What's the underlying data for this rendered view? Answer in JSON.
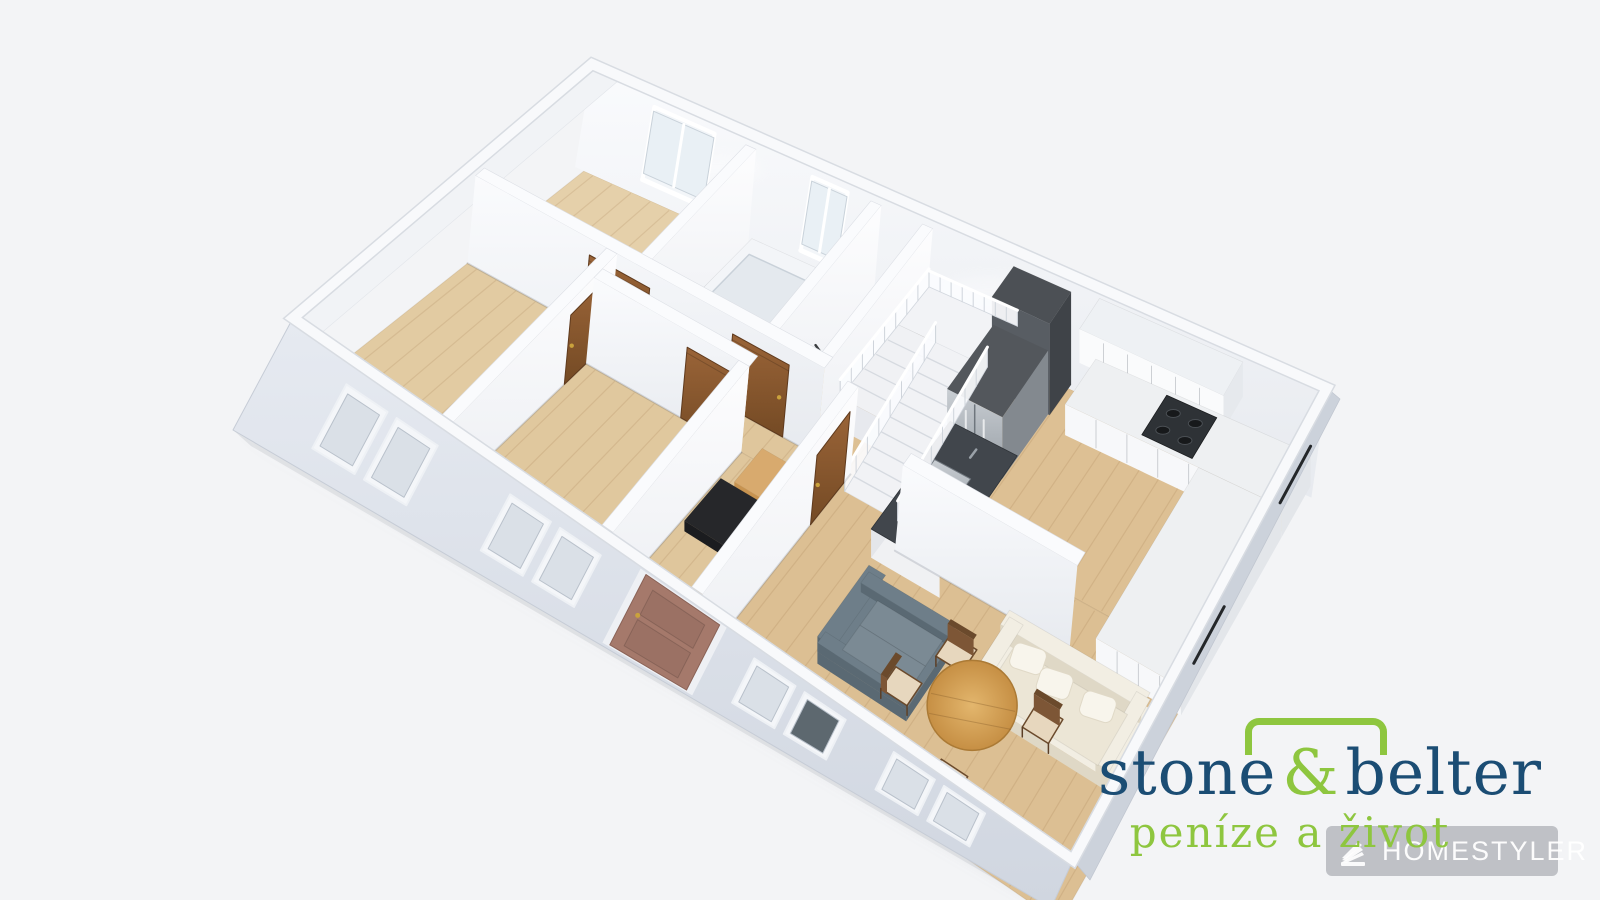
{
  "scene": {
    "background": "#f3f4f6",
    "width": 1600,
    "height": 900
  },
  "logo": {
    "word1": "stone",
    "amp": "&",
    "word2": "belter",
    "tagline": "peníze a život",
    "navy": "#1b4d74",
    "green": "#8ec63f"
  },
  "watermark": {
    "text": "HOMESTYLER",
    "bg": "rgba(148,152,158,0.55)",
    "fg": "#ffffff"
  },
  "plan": {
    "corners": {
      "N": [
        592,
        64
      ],
      "E": [
        1327,
        388
      ],
      "S": [
        1073,
        860
      ],
      "W": [
        293,
        318
      ]
    },
    "palette": {
      "wallTop": "#fafbfd",
      "wallEdge": "#dcdfe5",
      "facade": "#dde2ea",
      "facadeSide": "#ccd2db",
      "doorWood1": "#9a6438",
      "doorWood2": "#744a24",
      "entranceDoor": "#a5796b",
      "paneLight": "#dae0e7",
      "paneDark": "#5d686f",
      "steel1": "#c9ced3",
      "steel2": "#959ca3",
      "counterDark": "#41464c",
      "woodTable": "#d8a85c"
    },
    "rooms": [
      {
        "id": "bedroom-top",
        "a": [
          0.012,
          0.235
        ],
        "b": [
          0.03,
          0.42
        ],
        "fill": "#e5d0aa"
      },
      {
        "id": "bathroom",
        "a": [
          0.235,
          0.405
        ],
        "b": [
          0.03,
          0.42
        ],
        "fill": "#e9d6b2"
      },
      {
        "id": "wc",
        "a": [
          0.405,
          0.475
        ],
        "b": [
          0.03,
          0.42
        ],
        "fill": "#e9d6b2"
      },
      {
        "id": "bedroom-left",
        "a": [
          0.012,
          0.2
        ],
        "b": [
          0.42,
          0.985
        ],
        "fill": "#e2cba2"
      },
      {
        "id": "corridor-band",
        "a": [
          0.2,
          0.52
        ],
        "b": [
          0.42,
          0.5
        ],
        "fill": "#dfc69c"
      },
      {
        "id": "corridor-entry",
        "a": [
          0.405,
          0.52
        ],
        "b": [
          0.5,
          0.985
        ],
        "fill": "#dfc69c"
      },
      {
        "id": "bedroom-mid",
        "a": [
          0.2,
          0.405
        ],
        "b": [
          0.5,
          0.985
        ],
        "fill": "#e0c89e"
      },
      {
        "id": "kitchen",
        "a": [
          0.475,
          0.988
        ],
        "b": [
          0.03,
          0.42
        ],
        "fill": "#ddc094"
      },
      {
        "id": "living",
        "a": [
          0.52,
          0.988
        ],
        "b": [
          0.42,
          0.985
        ],
        "fill": "#dcbf93"
      }
    ],
    "windows_ne": [
      {
        "id": "window-bedroom-top",
        "a": [
          0.088,
          0.17
        ]
      },
      {
        "id": "window-bathroom",
        "a": [
          0.303,
          0.351
        ]
      }
    ],
    "facade_windows": [
      {
        "id": "window-bedroom-left-1",
        "t": [
          0.083,
          0.199
        ],
        "dark": false
      },
      {
        "id": "window-bedroom-mid",
        "t": [
          0.291,
          0.406
        ],
        "dark": false
      },
      {
        "id": "window-living-1",
        "t": [
          0.601,
          0.717
        ],
        "dark": true
      },
      {
        "id": "window-living-2",
        "t": [
          0.778,
          0.894
        ],
        "dark": false
      }
    ],
    "entrance": {
      "t": [
        0.458,
        0.552
      ]
    },
    "se_marks": [
      [
        0.1,
        0.22
      ],
      [
        0.44,
        0.56
      ]
    ],
    "elements": [
      {
        "kind": "wall_v",
        "id": "wall-bath-left",
        "a": 0.235,
        "b1": 0.03,
        "b2": 0.42
      },
      {
        "kind": "prism",
        "id": "bathtub",
        "a": [
          0.248,
          0.36
        ],
        "b": [
          0.05,
          0.4
        ],
        "k": 0.17,
        "top": "#f3f5f8",
        "front": "#e8ebf0",
        "side": "#dfe3e9",
        "tub": true
      },
      {
        "kind": "wall_v",
        "id": "wall-bath-right",
        "a": 0.405,
        "b1": 0.03,
        "b2": 0.42
      },
      {
        "kind": "towel",
        "id": "towel-bar"
      },
      {
        "kind": "wall_v",
        "id": "wall-stair-left",
        "a": 0.475,
        "b1": 0.03,
        "b2": 0.42
      },
      {
        "kind": "stairs",
        "id": "staircase"
      },
      {
        "kind": "prism",
        "id": "fridge-tall-cabinet",
        "a": [
          0.592,
          0.67
        ],
        "b": [
          0.02,
          0.1
        ],
        "k": 0.97,
        "top": "#4c5055",
        "front": "#585d63",
        "side": "#3f4348"
      },
      {
        "kind": "fridge",
        "id": "fridge",
        "a": [
          0.594,
          0.668
        ],
        "b": [
          0.1,
          0.27
        ],
        "k": 0.68
      },
      {
        "kind": "island",
        "id": "island-counter",
        "a": [
          0.598,
          0.688
        ],
        "b": [
          0.27,
          0.56
        ],
        "k": 0.34
      },
      {
        "kind": "prism",
        "id": "upper-cabinets",
        "a": [
          0.705,
          0.9
        ],
        "b": [
          0.01,
          0.085
        ],
        "k": 0.98,
        "kb": 0.62,
        "top": "#eef1f4",
        "front": "#fafbfc",
        "side": "#e6e9ed",
        "lines": 6
      },
      {
        "kind": "prism",
        "id": "lower-cabinets",
        "a": [
          0.7,
          0.992
        ],
        "b": [
          0.01,
          0.125
        ],
        "k": 0.33,
        "top": "#eef0f2",
        "front": "#f7f8fa",
        "side": "#e3e6ea",
        "lines": 7
      },
      {
        "kind": "cooktop",
        "id": "cooktop",
        "a": [
          0.8,
          0.868
        ],
        "b": [
          0.02,
          0.115
        ]
      },
      {
        "kind": "prism",
        "id": "cabinets-right-wall",
        "a": [
          0.88,
          0.992
        ],
        "b": [
          0.125,
          0.52
        ],
        "k": 0.33,
        "top": "#eef0f2",
        "front": "#f7f8fa",
        "side": "#e3e6ea",
        "lines": 4
      },
      {
        "kind": "wall_u",
        "id": "wall-hall-top",
        "b": 0.42,
        "a1": 0.012,
        "a2": 0.475
      },
      {
        "kind": "door_u",
        "id": "door-bedroom-top",
        "b": 0.42,
        "a1": 0.165,
        "a2": 0.245
      },
      {
        "kind": "door_u",
        "id": "door-bathroom",
        "b": 0.42,
        "a1": 0.355,
        "a2": 0.43
      },
      {
        "kind": "railing",
        "id": "stair-railing"
      },
      {
        "kind": "wall_v",
        "id": "wall-bedrooms-divider",
        "a": 0.2,
        "b1": 0.42,
        "b2": 0.985
      },
      {
        "kind": "door_v",
        "id": "door-bedroom-left",
        "a": 0.2,
        "b1": 0.455,
        "b2": 0.575
      },
      {
        "kind": "wall_u",
        "id": "wall-bedroom-mid-top",
        "b": 0.5,
        "a1": 0.2,
        "a2": 0.405
      },
      {
        "kind": "door_u",
        "id": "door-bedroom-mid",
        "b": 0.5,
        "a1": 0.325,
        "a2": 0.395
      },
      {
        "kind": "wall_v",
        "id": "wall-corridor-left",
        "a": 0.405,
        "b1": 0.5,
        "b2": 0.985
      },
      {
        "kind": "prism",
        "id": "console-shelf",
        "a": [
          0.44,
          0.53
        ],
        "b": [
          0.52,
          0.62
        ],
        "k": 0.3,
        "kb": 0.17,
        "top": "#d8aa6e",
        "front": "#c79350",
        "side": "#a87a3f"
      },
      {
        "kind": "prism",
        "id": "bench-black",
        "a": [
          0.415,
          0.495
        ],
        "b": [
          0.6,
          0.73
        ],
        "k": 0.13,
        "top": "#26272a",
        "front": "#1b1c1f",
        "side": "#151618"
      },
      {
        "kind": "wall_v",
        "id": "wall-living-left",
        "a": 0.52,
        "b1": 0.42,
        "b2": 0.985
      },
      {
        "kind": "door_v",
        "id": "door-living",
        "a": 0.52,
        "b1": 0.445,
        "b2": 0.565
      },
      {
        "kind": "wall_u",
        "id": "wall-kitchen-stub",
        "b": 0.52,
        "a1": 0.615,
        "a2": 0.845
      },
      {
        "kind": "sofa",
        "id": "sofa-cream",
        "a": [
          0.78,
          0.965
        ],
        "b": [
          0.56,
          0.72
        ],
        "back": "b1",
        "body": "#f2eee3",
        "seat": "#ece6d6",
        "side": "#dfd8c6",
        "pillows": true
      },
      {
        "kind": "chair",
        "id": "dining-chair-1",
        "c": [
          0.868,
          0.69
        ]
      },
      {
        "kind": "sofa",
        "id": "sofa-gray",
        "a": [
          0.62,
          0.735
        ],
        "b": [
          0.63,
          0.82
        ],
        "back": "a1",
        "body": "#6e7e89",
        "seat": "#7b8a94",
        "side": "#5a6973",
        "pillows": false
      },
      {
        "kind": "chair",
        "id": "dining-chair-2",
        "c": [
          0.745,
          0.66
        ]
      },
      {
        "kind": "table",
        "id": "dining-table",
        "c": [
          0.8,
          0.76
        ]
      },
      {
        "kind": "chair",
        "id": "dining-chair-3",
        "c": [
          0.715,
          0.78
        ]
      },
      {
        "kind": "chair",
        "id": "dining-chair-4",
        "c": [
          0.812,
          0.89
        ]
      }
    ]
  }
}
